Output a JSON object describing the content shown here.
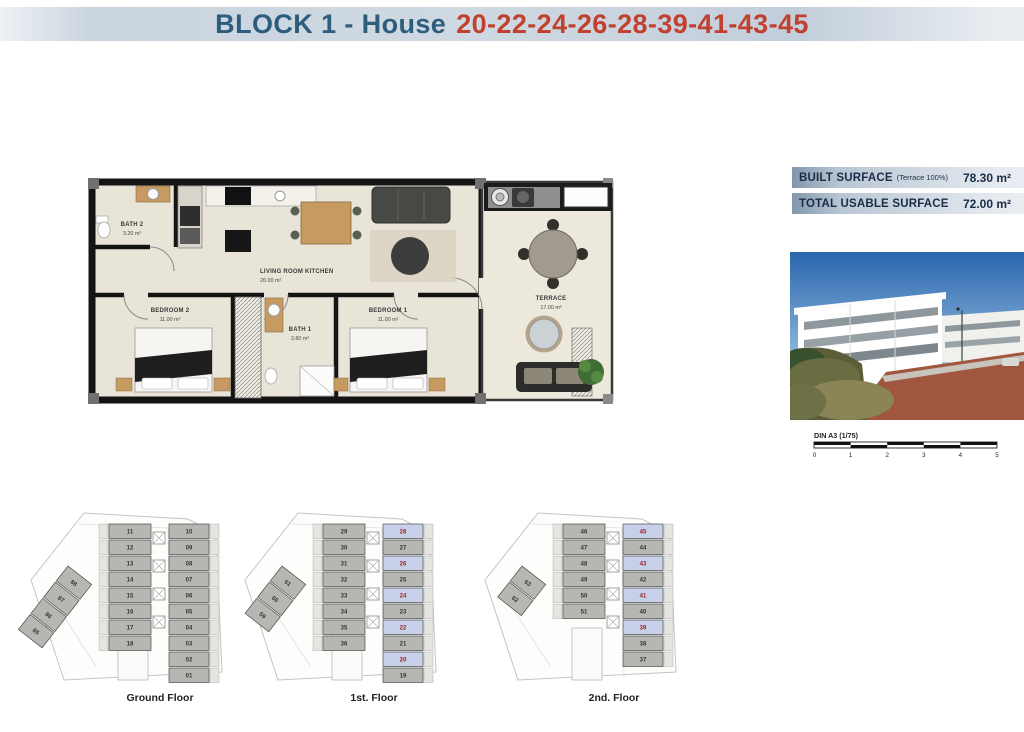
{
  "header": {
    "title": "BLOCK 1 - House",
    "house_numbers": "20-22-24-26-28-39-41-43-45"
  },
  "floorplan": {
    "rooms": [
      {
        "name": "BATH 2",
        "area": "3.20 m²"
      },
      {
        "name": "LIVING ROOM KITCHEN",
        "area": "26.00 m²"
      },
      {
        "name": "BEDROOM 2",
        "area": "11.00 m²"
      },
      {
        "name": "BATH 1",
        "area": "3.80 m²"
      },
      {
        "name": "BEDROOM 1",
        "area": "11.00 m²"
      },
      {
        "name": "TERRACE",
        "area": "17.00 m²"
      }
    ]
  },
  "surfaces": {
    "rows": [
      {
        "label": "BUILT SURFACE",
        "note": "(Terrace 100%)",
        "value": "78.30 m²"
      },
      {
        "label": "TOTAL USABLE SURFACE",
        "note": "",
        "value": "72.00 m²"
      }
    ]
  },
  "scalebar": {
    "label": "DIN A3 (1/75)",
    "ticks": [
      "0",
      "1",
      "2",
      "3",
      "4",
      "5"
    ]
  },
  "floors": [
    {
      "label": "Ground Floor",
      "diagonal": [
        "88",
        "87",
        "86",
        "85"
      ],
      "middle": [
        "11",
        "12",
        "13",
        "14",
        "15",
        "16",
        "17",
        "18"
      ],
      "right": [
        "10",
        "09",
        "08",
        "07",
        "06",
        "05",
        "04",
        "03",
        "02",
        "01"
      ],
      "highlight": []
    },
    {
      "label": "1st. Floor",
      "diagonal": [
        "61",
        "60",
        "59"
      ],
      "middle": [
        "29",
        "30",
        "31",
        "32",
        "33",
        "34",
        "35",
        "36"
      ],
      "right": [
        "28",
        "27",
        "26",
        "25",
        "24",
        "23",
        "22",
        "21",
        "20",
        "19"
      ],
      "highlight": [
        "28",
        "26",
        "24",
        "22",
        "20"
      ]
    },
    {
      "label": "2nd. Floor",
      "diagonal": [
        "63",
        "62"
      ],
      "middle": [
        "46",
        "47",
        "48",
        "49",
        "50",
        "51"
      ],
      "right": [
        "45",
        "44",
        "43",
        "42",
        "41",
        "40",
        "39",
        "38",
        "37"
      ],
      "highlight": [
        "45",
        "43",
        "41",
        "39"
      ]
    }
  ],
  "colors": {
    "title_blue": "#2d5d7c",
    "accent_red": "#c2402e",
    "highlight_unit_bg": "#c7d0e9",
    "highlight_unit_text": "#9c1f1f"
  }
}
